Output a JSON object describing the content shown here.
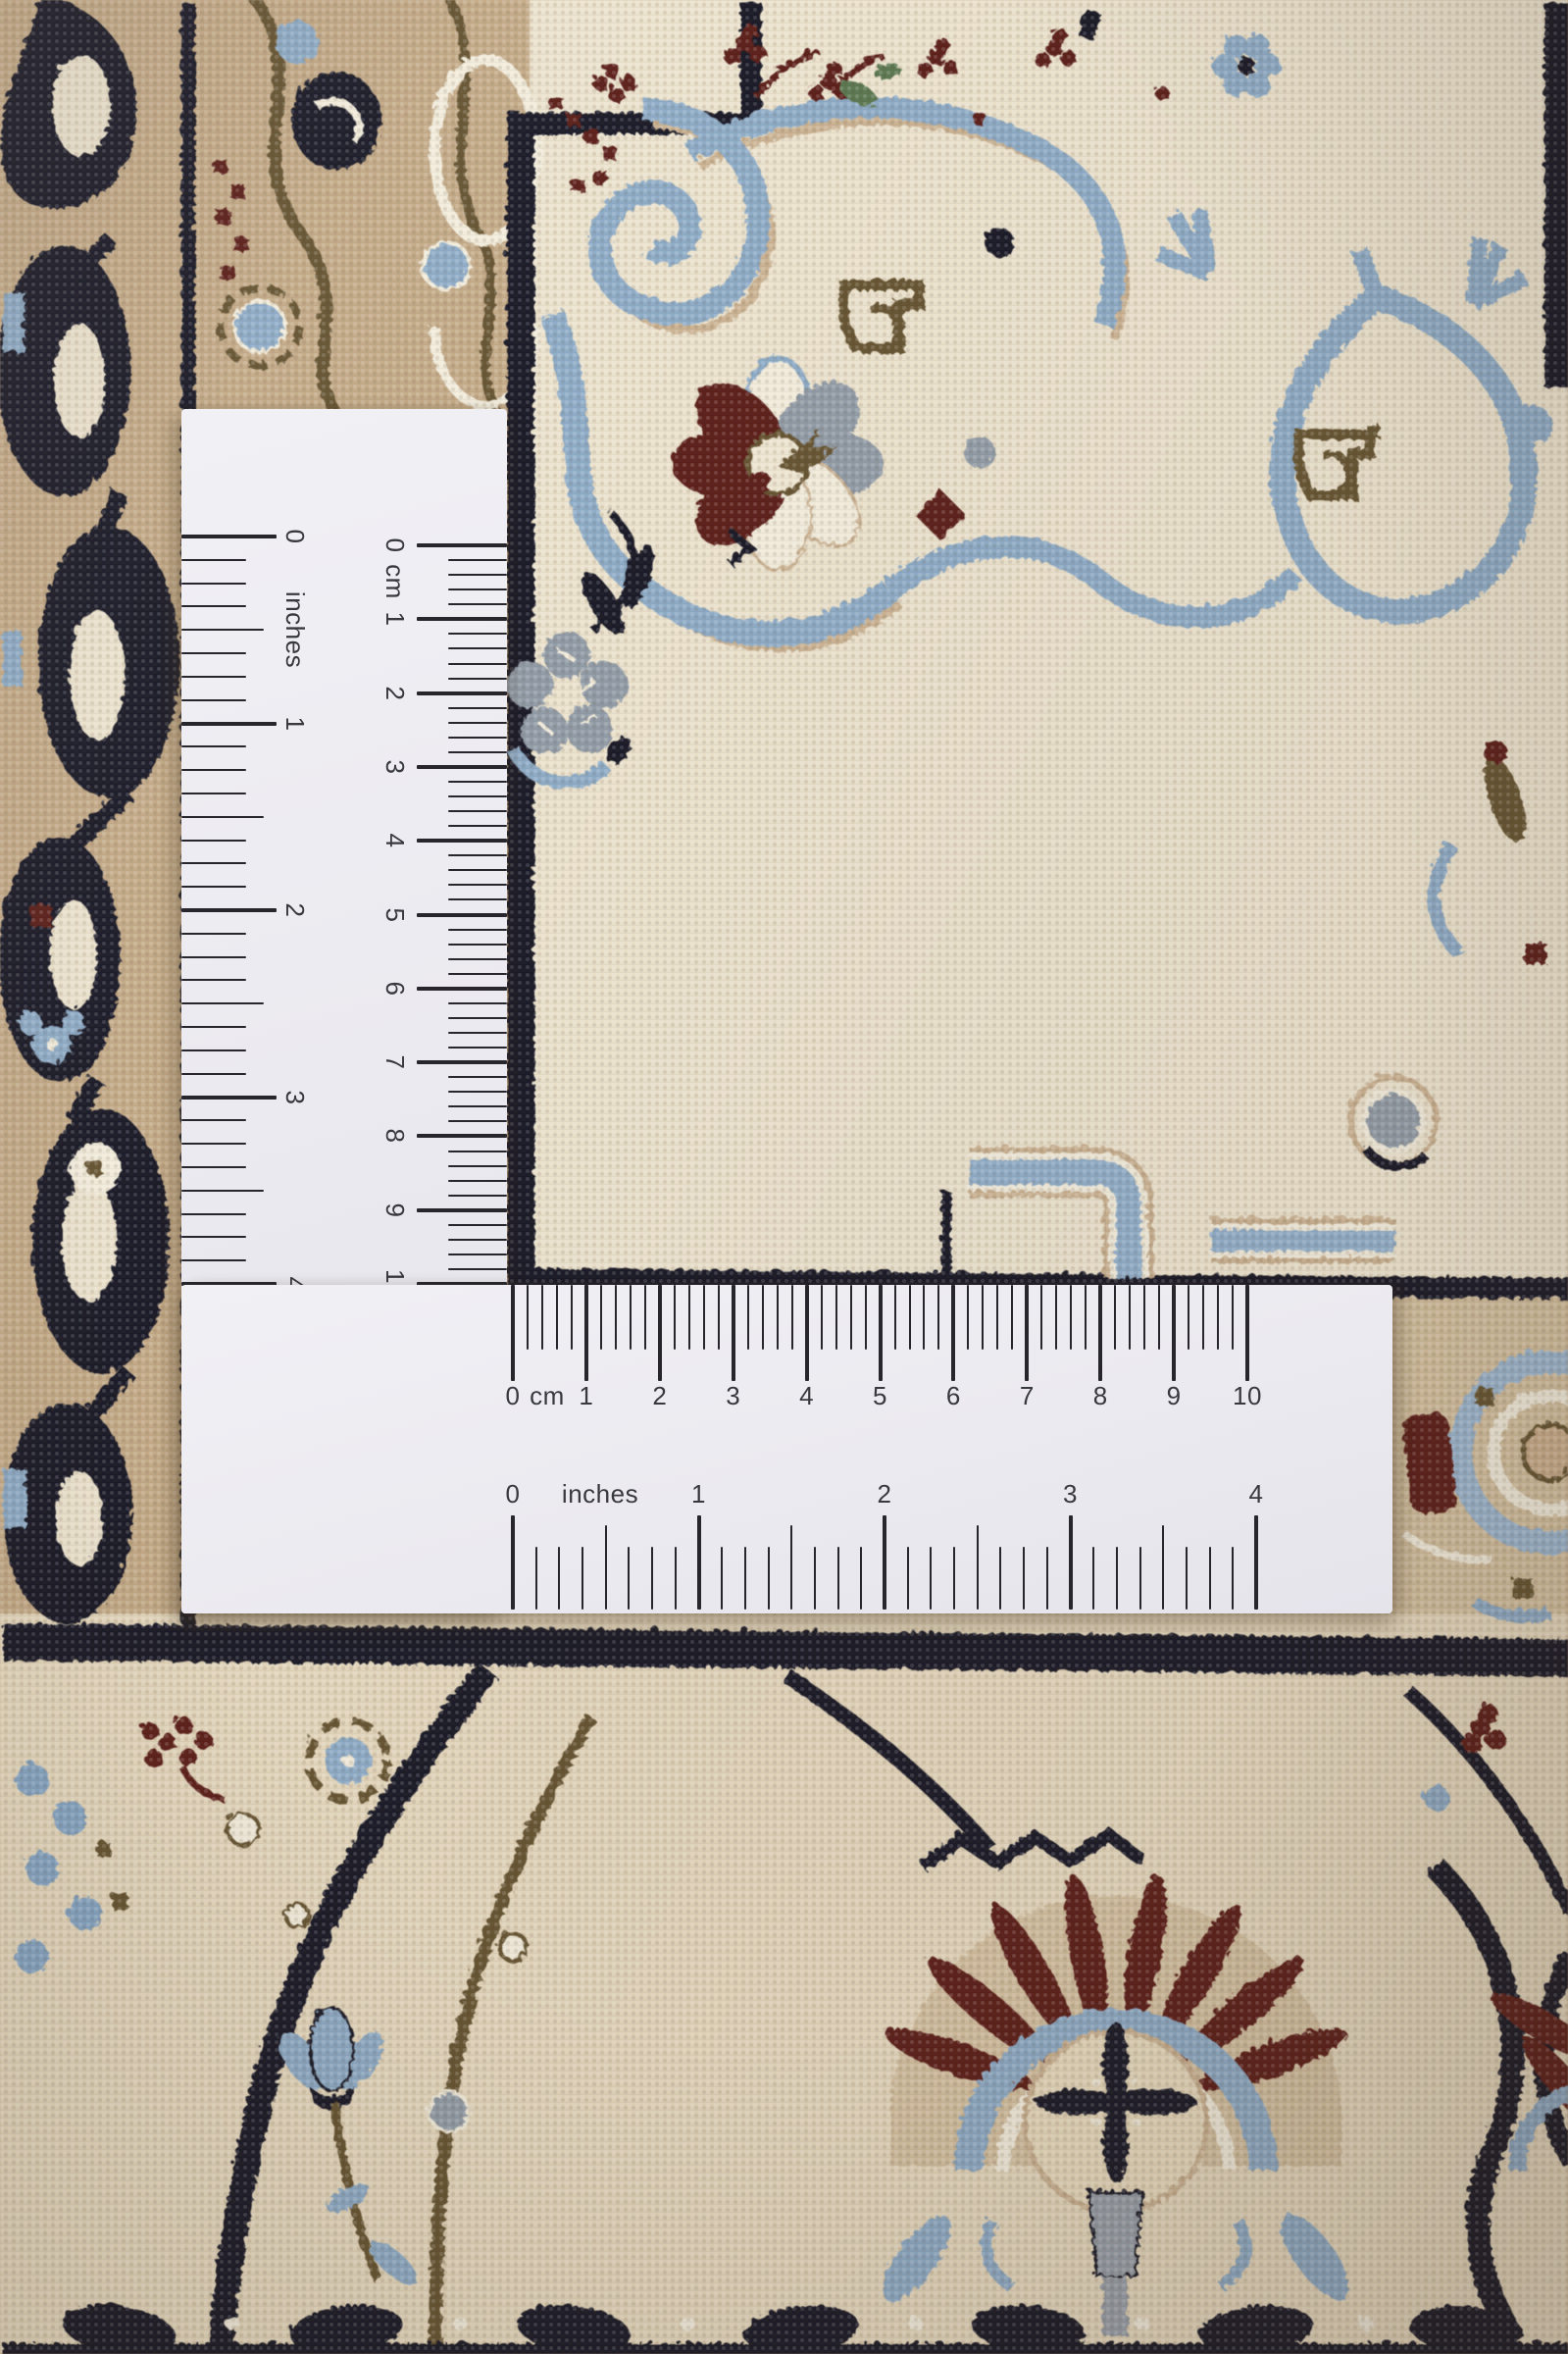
{
  "scene": {
    "description": "Close-up photograph of a cream, beige and navy Persian Nain wool rug with an L-shaped white paper corner ruler laid on top showing centimetre and inch scales",
    "photo_subject": "rug-with-measuring-ruler"
  },
  "ruler": {
    "paper_color": "#ebeaf0",
    "tick_color": "#26262c",
    "label_color": "#38383f",
    "vertical_arm": {
      "inches": {
        "unit_label": "inches",
        "numbers": [
          "0",
          "1",
          "2",
          "3",
          "4"
        ]
      },
      "cm": {
        "unit_label": "cm",
        "numbers": [
          "0",
          "1",
          "2",
          "3",
          "4",
          "5",
          "6",
          "7",
          "8",
          "9",
          "10"
        ]
      }
    },
    "horizontal_arm": {
      "cm": {
        "unit_label": "cm",
        "numbers": [
          "0",
          "1",
          "2",
          "3",
          "4",
          "5",
          "6",
          "7",
          "8",
          "9",
          "10"
        ]
      },
      "inches": {
        "unit_label": "inches",
        "numbers": [
          "0",
          "1",
          "2",
          "3",
          "4"
        ]
      }
    }
  },
  "carpet": {
    "style": "Persian Nain rug close-up",
    "palette": {
      "ivory": "#ece3cd",
      "beige": "#e5d8bd",
      "tan": "#c6ac89",
      "tan_light": "#d6c2a2",
      "navy": "#1a1b29",
      "light_blue": "#8fadc9",
      "blue_pale": "#9db8d2",
      "maroon": "#61231f",
      "gray": "#949ea9",
      "brown": "#6b5836",
      "cream": "#f2ecdb",
      "green": "#5d7a52"
    }
  }
}
